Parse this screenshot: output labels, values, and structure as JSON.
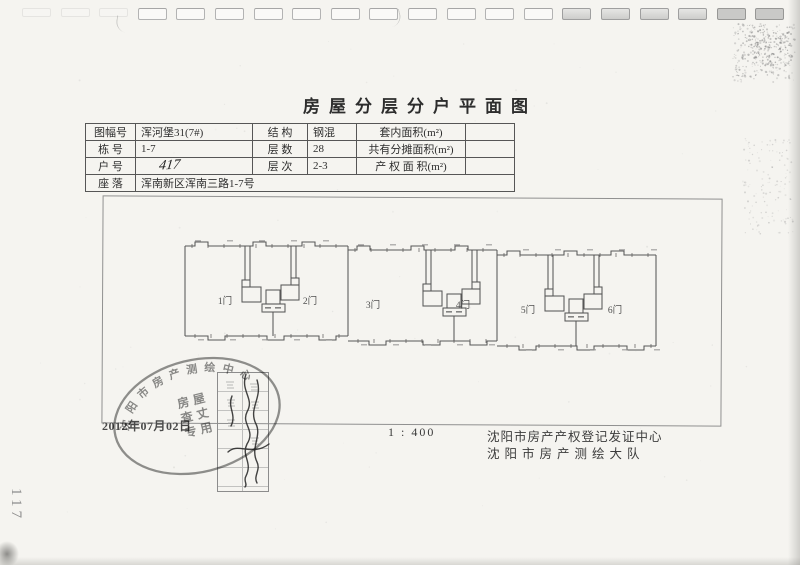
{
  "page_number": "117",
  "title": "房屋分层分户平面图",
  "info_table": {
    "rows": [
      [
        "图幅号",
        "浑河堡31(7#)",
        "结 构",
        "钢混",
        "套内面积(m²)",
        ""
      ],
      [
        "栋 号",
        "1-7",
        "层 数",
        "28",
        "共有分摊面积(m²)",
        ""
      ],
      [
        "户 号",
        "417",
        "层 次",
        "2-3",
        "产 权 面 积(m²)",
        ""
      ],
      [
        "座 落",
        "浑南新区浑南三路1-7号"
      ]
    ]
  },
  "plan": {
    "units": [
      "1门",
      "2门",
      "3门",
      "4门",
      "5门",
      "6门"
    ]
  },
  "stamp": {
    "ring_text": "沈阳市房产测绘中心",
    "center_line1": "房屋",
    "center_line2": "查丈",
    "center_line3": "专用",
    "date": "2012年07月02日"
  },
  "footer": {
    "scale": "1 : 400",
    "org_line1": "沈阳市房产产权登记发证中心",
    "org_line2": "沈阳市房产测绘大队"
  },
  "colors": {
    "paper": "#f5f4f0",
    "ink": "#474747",
    "stamp_ink": "#7b7b7b"
  }
}
